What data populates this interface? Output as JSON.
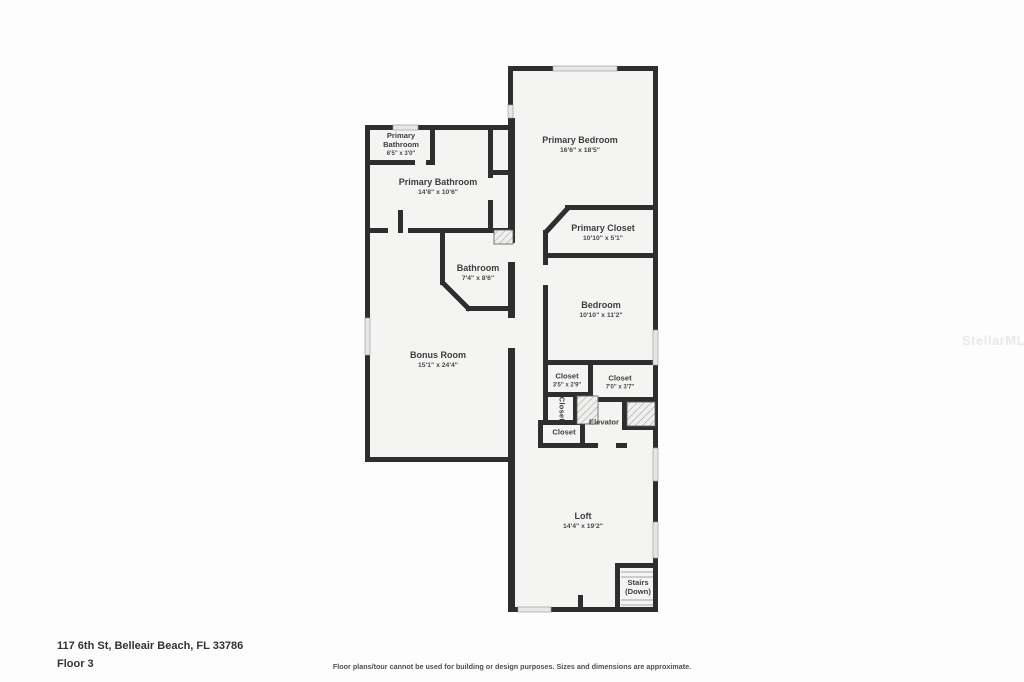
{
  "page": {
    "address": "117 6th St, Belleair Beach, FL 33786",
    "floor_label": "Floor 3",
    "disclaimer": "Floor plans/tour cannot be used for building or design purposes. Sizes and dimensions are approximate.",
    "watermark": "StellarMLS"
  },
  "rooms": {
    "primary_bathroom_small": {
      "name": "Primary Bathroom",
      "dims": "6'5\" x 3'0\""
    },
    "primary_bathroom": {
      "name": "Primary Bathroom",
      "dims": "14'8\" x 10'6\""
    },
    "primary_bedroom": {
      "name": "Primary Bedroom",
      "dims": "16'6\" x 18'5\""
    },
    "primary_closet": {
      "name": "Primary Closet",
      "dims": "10'10\" x 5'1\""
    },
    "bathroom": {
      "name": "Bathroom",
      "dims": "7'4\" x 8'6\""
    },
    "bedroom": {
      "name": "Bedroom",
      "dims": "10'10\" x 11'2\""
    },
    "bonus_room": {
      "name": "Bonus Room",
      "dims": "15'1\" x 24'4\""
    },
    "closet_small": {
      "name": "Closet",
      "dims": "3'5\" x 2'9\""
    },
    "closet_wide": {
      "name": "Closet",
      "dims": "7'0\" x 3'7\""
    },
    "closet_vertical": {
      "name": "Closet"
    },
    "closet_lower": {
      "name": "Closet"
    },
    "elevator": {
      "name": "Elevator"
    },
    "loft": {
      "name": "Loft",
      "dims": "14'4\" x 19'2\""
    },
    "stairs": {
      "name": "Stairs",
      "sub": "(Down)"
    }
  },
  "colors": {
    "wall": "#2e2e2e",
    "room_fill": "#f4f4f3",
    "window_fill": "#e7e7e7",
    "text": "#3d3d3d",
    "watermark": "#e9e9e9"
  }
}
